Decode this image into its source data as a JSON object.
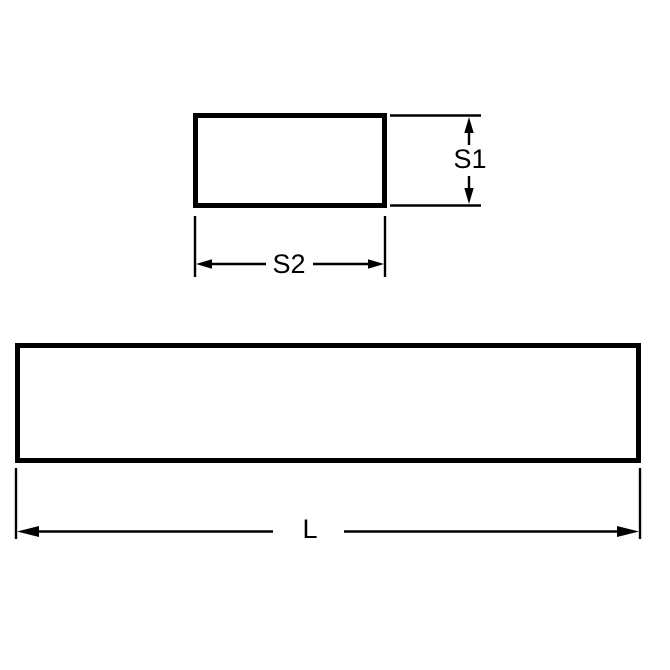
{
  "drawing": {
    "kind": "technical-dimension-drawing",
    "background_color": "#ffffff",
    "line_color": "#000000",
    "views": {
      "cross_section": {
        "shape": "rectangle",
        "height_label": "S1",
        "width_label": "S2"
      },
      "side_view": {
        "shape": "rectangle",
        "length_label": "L"
      }
    }
  }
}
